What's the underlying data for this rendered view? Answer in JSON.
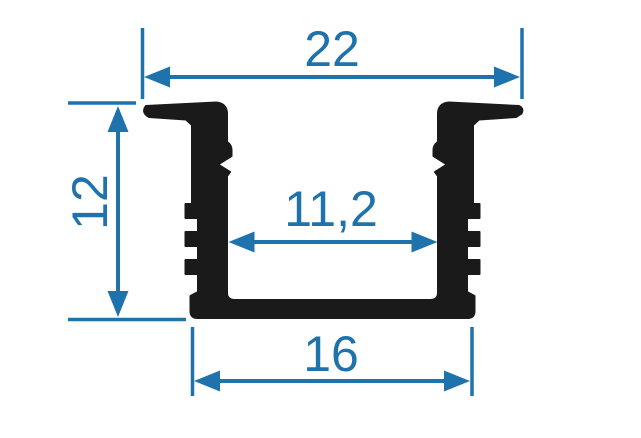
{
  "dimensions": {
    "overall_width": "22",
    "height": "12",
    "inner_width": "11,2",
    "base_width": "16"
  },
  "colors": {
    "dimension_accent": "#1e73ad",
    "profile_fill": "#1a1a1a",
    "background": "#ffffff"
  }
}
